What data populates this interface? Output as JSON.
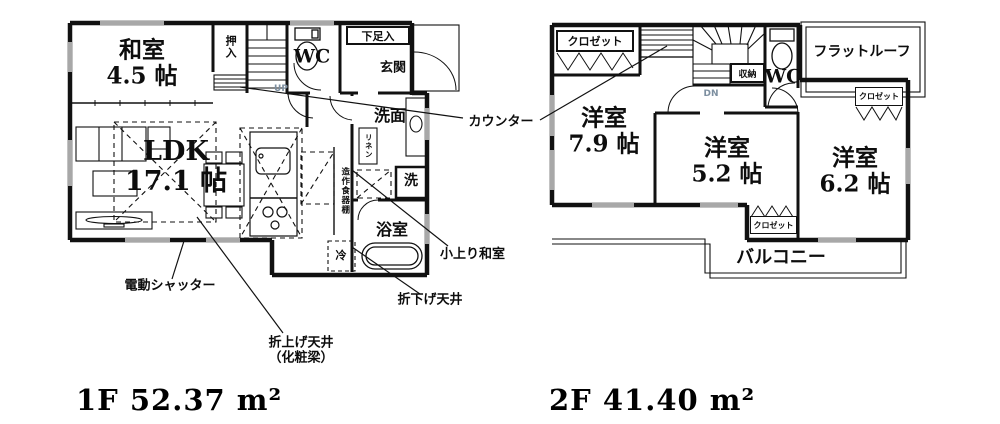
{
  "f1": {
    "area_label": "1F 52.37 m²",
    "rooms": {
      "washitsu": "和室\n4.5 帖",
      "ldk": "LDK\n17.1 帖",
      "oshiire": "押入",
      "wc": "WC",
      "shoe": "下足入",
      "genkan": "玄関",
      "senmen": "洗面",
      "linen": "リネン",
      "washer": "洗",
      "bath": "浴室",
      "cupboard": "造作食器棚",
      "fridge": "冷",
      "stairs_up": "UP"
    },
    "annotations": {
      "counter": "カウンター",
      "koagari": "小上り和室",
      "shutter": "電動シャッター",
      "orisage": "折下げ天井",
      "oriage": "折上げ天井\n（化粧梁）"
    }
  },
  "f2": {
    "area_label": "2F 41.40 m²",
    "rooms": {
      "closet_top_left": "クロゼット",
      "storage": "収納",
      "stairs_down": "DN",
      "wc": "WC",
      "flat_roof": "フラットルーフ",
      "closet_right": "クロゼット",
      "west_room_79": "洋室\n7.9 帖",
      "west_room_52": "洋室\n5.2 帖",
      "west_room_62": "洋室\n6.2 帖",
      "closet_bottom": "クロゼット",
      "balcony": "バルコニー"
    }
  },
  "colors": {
    "line": "#111111",
    "window": "#a8a8a8",
    "stair_text": "#7d8fa0"
  }
}
